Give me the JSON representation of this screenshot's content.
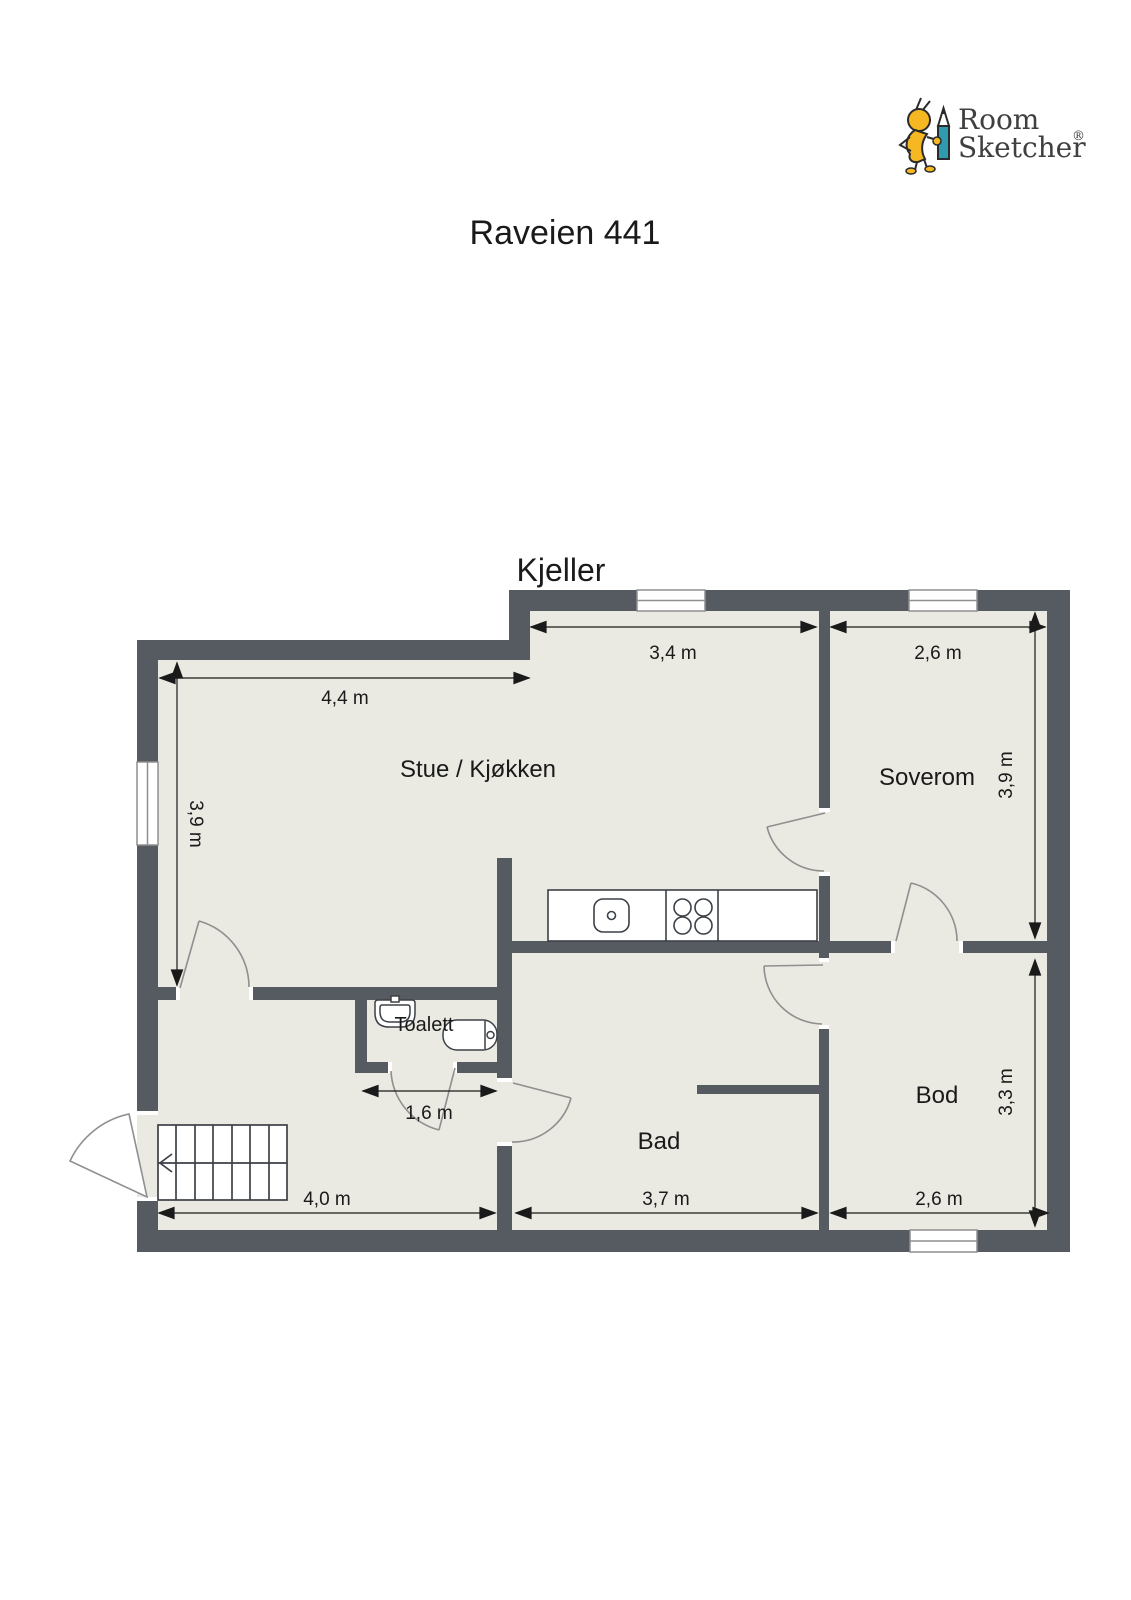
{
  "title": "Raveien 441",
  "floor_label": "Kjeller",
  "logo": {
    "line1": "Room",
    "line2": "Sketcher",
    "registered": "®",
    "brand_yellow": "#f5b823",
    "brand_teal": "#2f9bb0",
    "text_color": "#3f3f3f"
  },
  "rooms": [
    {
      "name": "Stue / Kjøkken"
    },
    {
      "name": "Soverom"
    },
    {
      "name": "Toalett"
    },
    {
      "name": "Bad"
    },
    {
      "name": "Bod"
    }
  ],
  "dimensions": [
    {
      "label": "4,4 m",
      "room": "Stue / Kjøkken",
      "edge": "top"
    },
    {
      "label": "3,9 m",
      "room": "Stue / Kjøkken",
      "edge": "left"
    },
    {
      "label": "3,4 m",
      "room": "Stue / Kjøkken",
      "edge": "kitchen-top"
    },
    {
      "label": "2,6 m",
      "room": "Soverom",
      "edge": "top"
    },
    {
      "label": "3,9 m",
      "room": "Soverom",
      "edge": "right"
    },
    {
      "label": "1,6 m",
      "room": "Toalett",
      "edge": "bottom"
    },
    {
      "label": "4,0 m",
      "room": "Hall",
      "edge": "bottom"
    },
    {
      "label": "3,7 m",
      "room": "Bad",
      "edge": "bottom"
    },
    {
      "label": "2,6 m",
      "room": "Bod",
      "edge": "bottom"
    },
    {
      "label": "3,3 m",
      "room": "Bod",
      "edge": "right"
    }
  ],
  "colors": {
    "wall": "#565b61",
    "floor": "#eae9e2",
    "outside": "#ffffff",
    "door_stroke": "#8f8f8f",
    "fixture_stroke": "#3c4147",
    "text": "#1a1a1a"
  }
}
